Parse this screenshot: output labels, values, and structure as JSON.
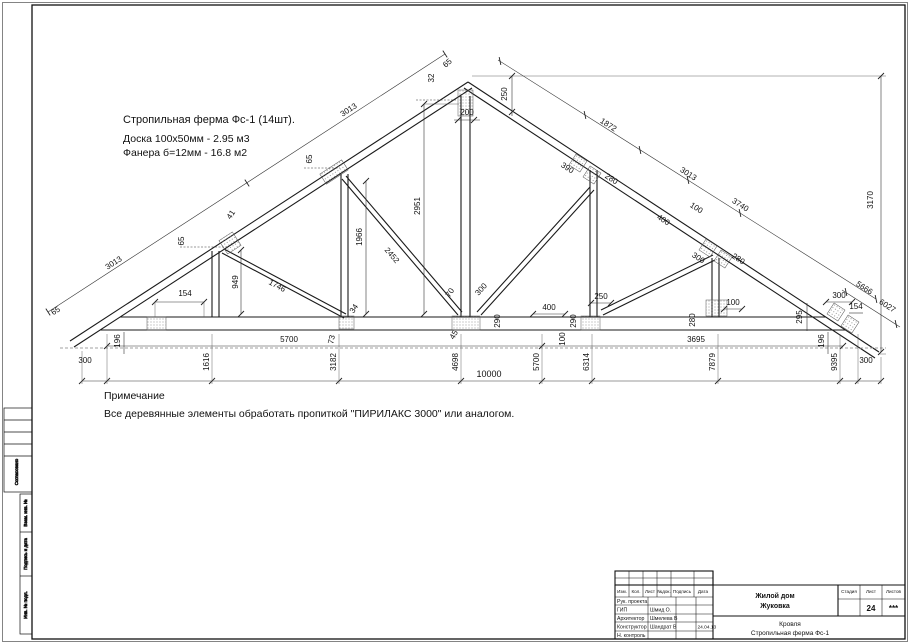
{
  "colors": {
    "line": "#1a1a1a",
    "dim_line": "#333333",
    "dashed_line": "#a0a0a0",
    "paper": "#ffffff"
  },
  "notes": {
    "spec_line1": "Стропильная ферма  Фс-1 (14шт).",
    "spec_line2": "Доска 100х50мм - 2.95 м3",
    "spec_line3": "Фанера б=12мм - 16.8 м2",
    "note_title": "Примечание",
    "note_body": "Все деревянные элементы обработать пропиткой \"ПИРИЛАКС 3000\" или аналогом."
  },
  "dims": {
    "rafterL": {
      "seg1": "3013",
      "seg2": "3013",
      "tip65": "65",
      "n1_65": "65",
      "n1_41": "41",
      "post1": "949",
      "diag1": "1746",
      "n2_65": "65",
      "post2": "1966",
      "diag2": "2452",
      "d34": "34",
      "d73": "73",
      "s154": "154",
      "s196": "196"
    },
    "peak": {
      "k32": "32",
      "k65": "65",
      "k250": "250",
      "k200": "200",
      "king": "2951"
    },
    "rafterR": {
      "a1872": "1872",
      "n390": "390",
      "n280": "280",
      "seg3013": "3013",
      "a400": "400",
      "a100": "100",
      "a3740": "3740",
      "n4_300": "300",
      "n4_280": "280",
      "a5666": "5666",
      "a6027": "6027",
      "h3170": "3170"
    },
    "chord": {
      "c70": "70",
      "c300": "300",
      "c45": "45",
      "c290a": "290",
      "c400": "400",
      "c290b": "290",
      "c100a": "100",
      "c250": "250",
      "c280": "280",
      "c100b": "100",
      "c295": "295",
      "c300b": "300",
      "c154": "154",
      "c196": "196"
    },
    "bottom": {
      "row5700": "5700",
      "row3695": "3695",
      "b300l": "300",
      "b1616": "1616",
      "b3182": "3182",
      "b4698": "4698",
      "b10000": "10000",
      "b5700": "5700",
      "b6314": "6314",
      "b7879": "7879",
      "b9395": "9395",
      "b300r": "300"
    }
  },
  "margin": {
    "agreed": "Согласовано",
    "vzam": "Взам. инв. №",
    "podpis": "Подпись и дата",
    "inv": "Инв. № подл."
  },
  "title_block": {
    "cols": [
      "Изм.",
      "Кол.",
      "Лист",
      "№док.",
      "Подпись",
      "Дата"
    ],
    "rows": [
      {
        "role": "Рук. проекта",
        "name": "",
        "date": ""
      },
      {
        "role": "ГИП",
        "name": "Шмид О.",
        "date": ""
      },
      {
        "role": "Архитектор",
        "name": "Шмелева В",
        "date": ""
      },
      {
        "role": "Конструктор",
        "name": "Шандрат В",
        "date": "24.04.13"
      },
      {
        "role": "Н. контроль",
        "name": "",
        "date": ""
      }
    ],
    "project": {
      "line1": "Жилой дом",
      "line2": "Жуковка"
    },
    "drawing": {
      "line1": "Кровля",
      "line2": "Стропильная ферма Фс-1"
    },
    "stage_label": "Стадия",
    "sheet_label": "Лист",
    "sheets_label": "Листов",
    "stage": "",
    "sheet_no": "24",
    "sheets": "***"
  }
}
